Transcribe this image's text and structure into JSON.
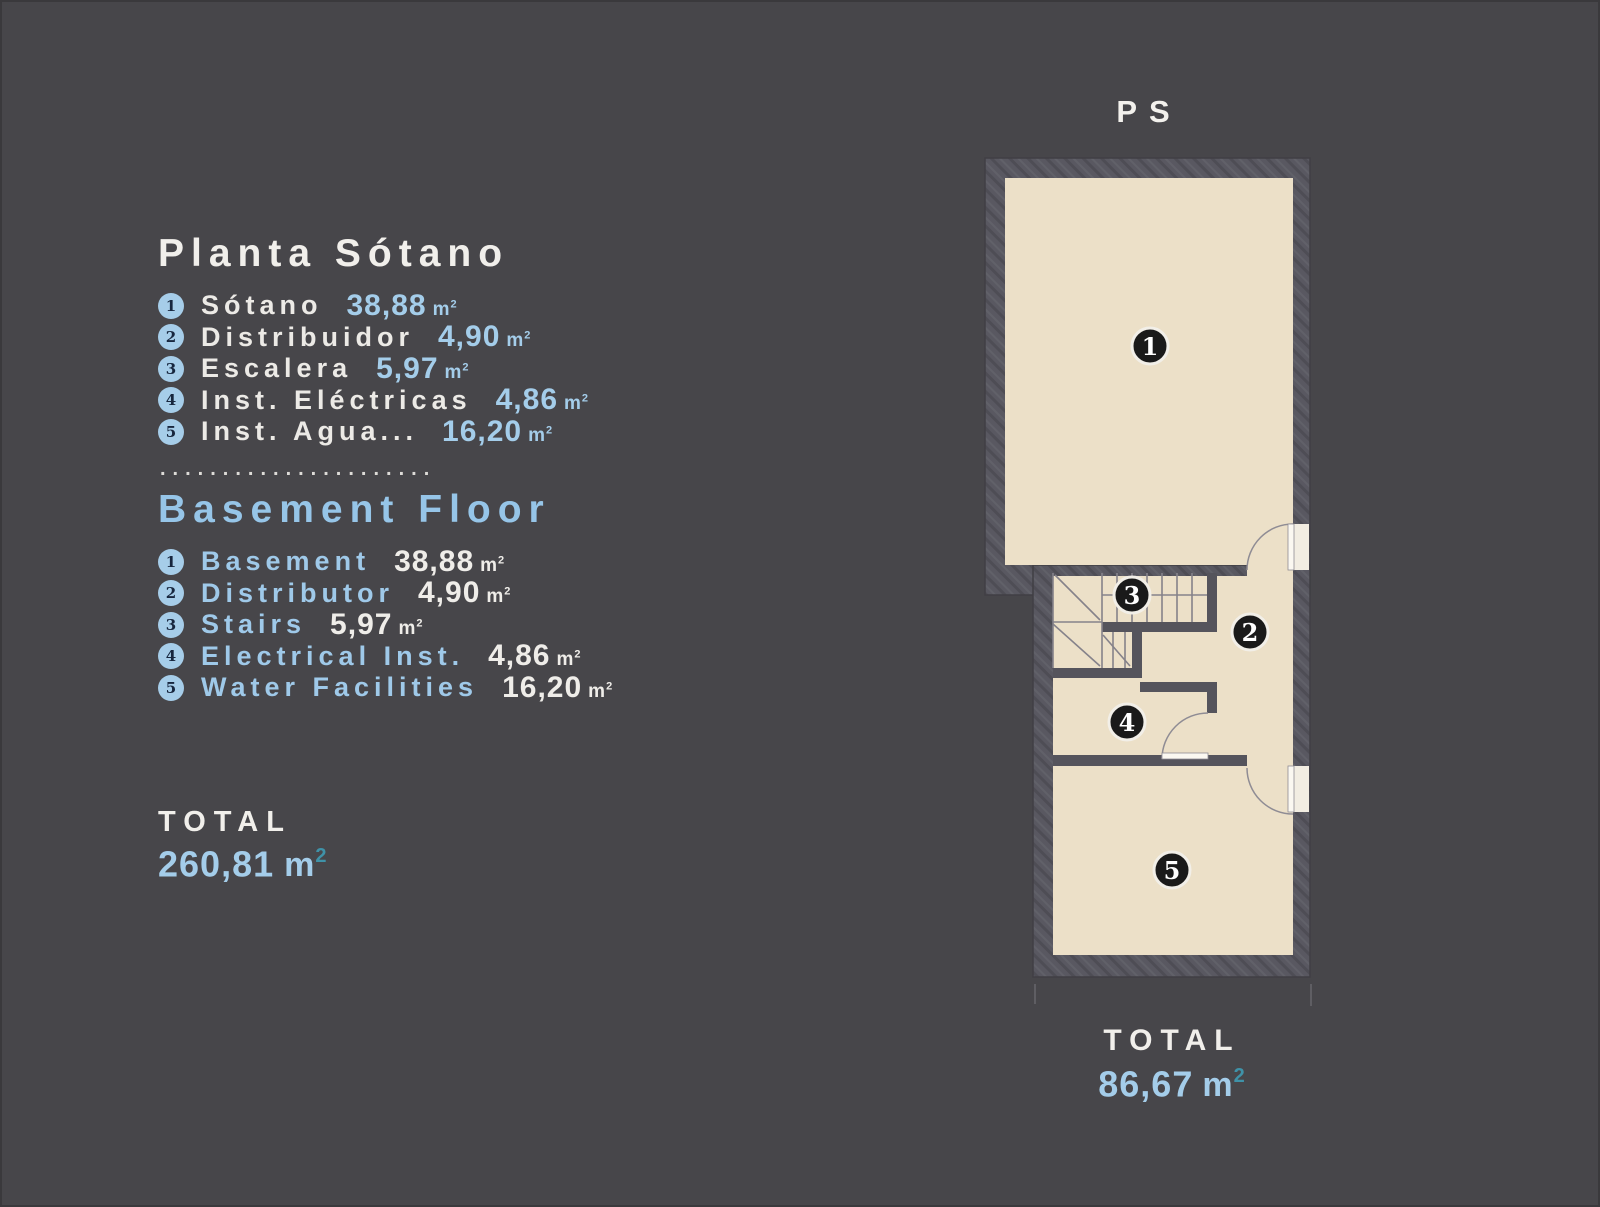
{
  "colors": {
    "background": "#47464a",
    "wall": "#595861",
    "floor_cream": "#ece0c8",
    "accent_blue": "#a4cdea",
    "title_blue": "#96c5e8",
    "teal_superscript": "#3f92a8",
    "text_white": "#f1efeb",
    "bullet_blue": "#a6cde9",
    "marker_black": "#1a1a1a"
  },
  "units": {
    "m": "m",
    "exp": "2"
  },
  "legend_es": {
    "title": "Planta Sótano",
    "items": [
      {
        "num": "1",
        "label": "Sótano",
        "value": "38,88"
      },
      {
        "num": "2",
        "label": "Distribuidor",
        "value": "4,90"
      },
      {
        "num": "3",
        "label": "Escalera",
        "value": "5,97"
      },
      {
        "num": "4",
        "label": "Inst. Eléctricas",
        "value": "4,86"
      },
      {
        "num": "5",
        "label": "Inst. Agua...",
        "value": "16,20"
      }
    ]
  },
  "separator": "......................",
  "legend_en": {
    "title": "Basement Floor",
    "items": [
      {
        "num": "1",
        "label": "Basement",
        "value": "38,88"
      },
      {
        "num": "2",
        "label": "Distributor",
        "value": "4,90"
      },
      {
        "num": "3",
        "label": "Stairs",
        "value": "5,97"
      },
      {
        "num": "4",
        "label": "Electrical Inst.",
        "value": "4,86"
      },
      {
        "num": "5",
        "label": "Water Facilities",
        "value": "16,20"
      }
    ]
  },
  "total_left": {
    "label": "TOTAL",
    "value": "260,81"
  },
  "plan": {
    "label": "PS",
    "rooms": [
      {
        "num": "1"
      },
      {
        "num": "2"
      },
      {
        "num": "3"
      },
      {
        "num": "4"
      },
      {
        "num": "5"
      }
    ],
    "total": {
      "label": "TOTAL",
      "value": "86,67"
    }
  }
}
